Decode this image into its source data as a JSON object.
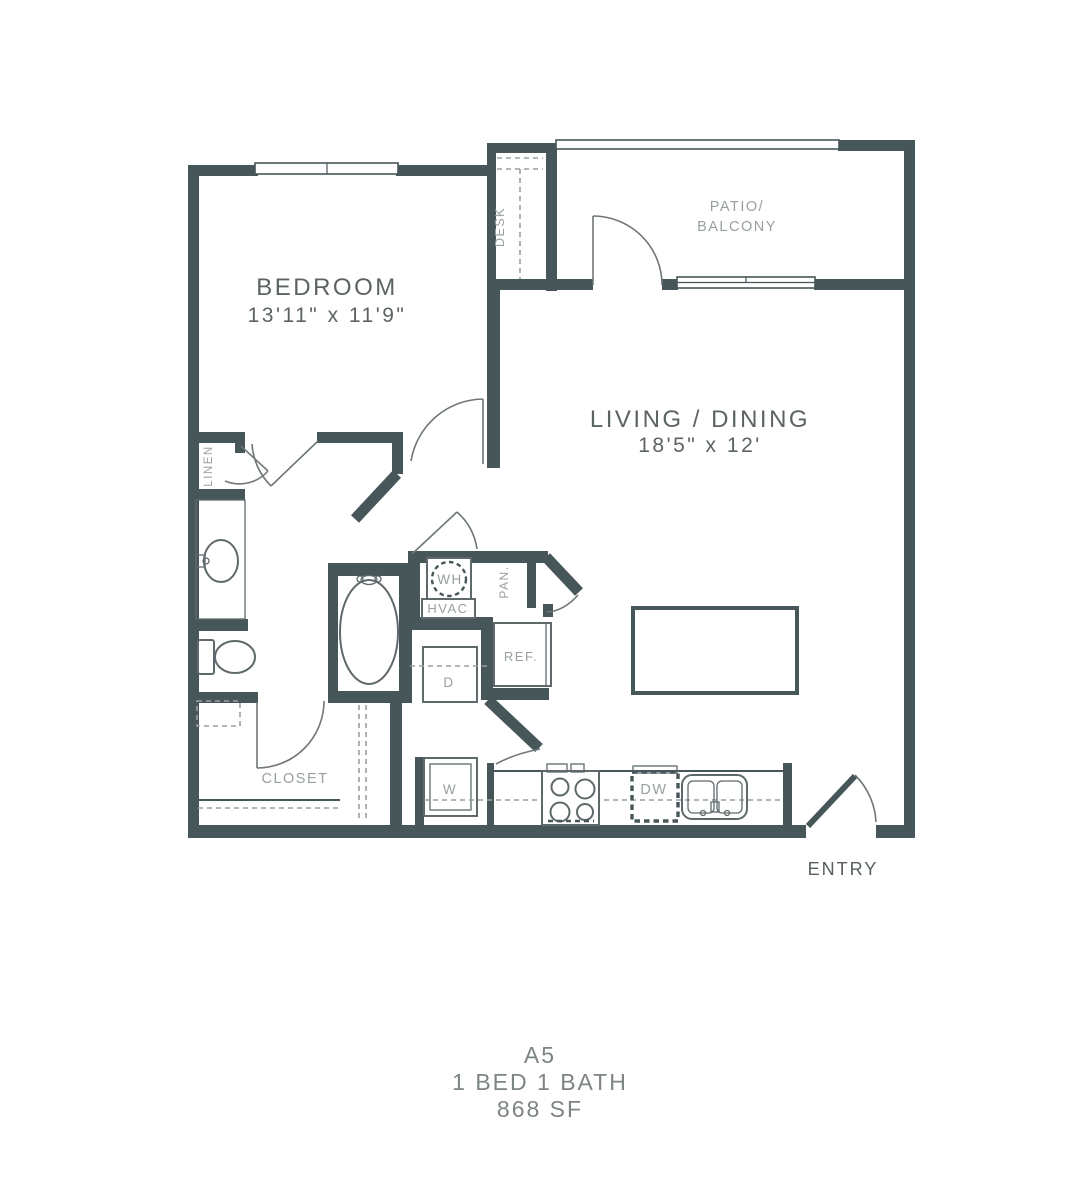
{
  "plan": {
    "unit": "A5",
    "config": "1 BED  1 BATH",
    "area": "868  SF",
    "rooms": {
      "bedroom": {
        "name": "BEDROOM",
        "dims": "13'11\" x 11'9\""
      },
      "living": {
        "name": "LIVING / DINING",
        "dims": "18'5\" x 12'"
      },
      "patio": {
        "line1": "PATIO/",
        "line2": "BALCONY"
      },
      "closet": {
        "name": "CLOSET"
      },
      "entry": {
        "name": "ENTRY"
      }
    },
    "fixtures": {
      "desk": "DESK",
      "linen": "LINEN",
      "water_heater": "WH",
      "hvac": "HVAC",
      "pantry": "PAN.",
      "refrigerator": "REF.",
      "dryer": "D",
      "washer": "W",
      "dishwasher": "DW"
    }
  },
  "colors": {
    "wall": "#465659",
    "door": "#6f7778",
    "fixture": "#5f696b",
    "label_gray": "#98a0a0",
    "label_dark": "#5c6364",
    "entry_gray": "#565e5f",
    "title_gray": "#7d8485"
  }
}
